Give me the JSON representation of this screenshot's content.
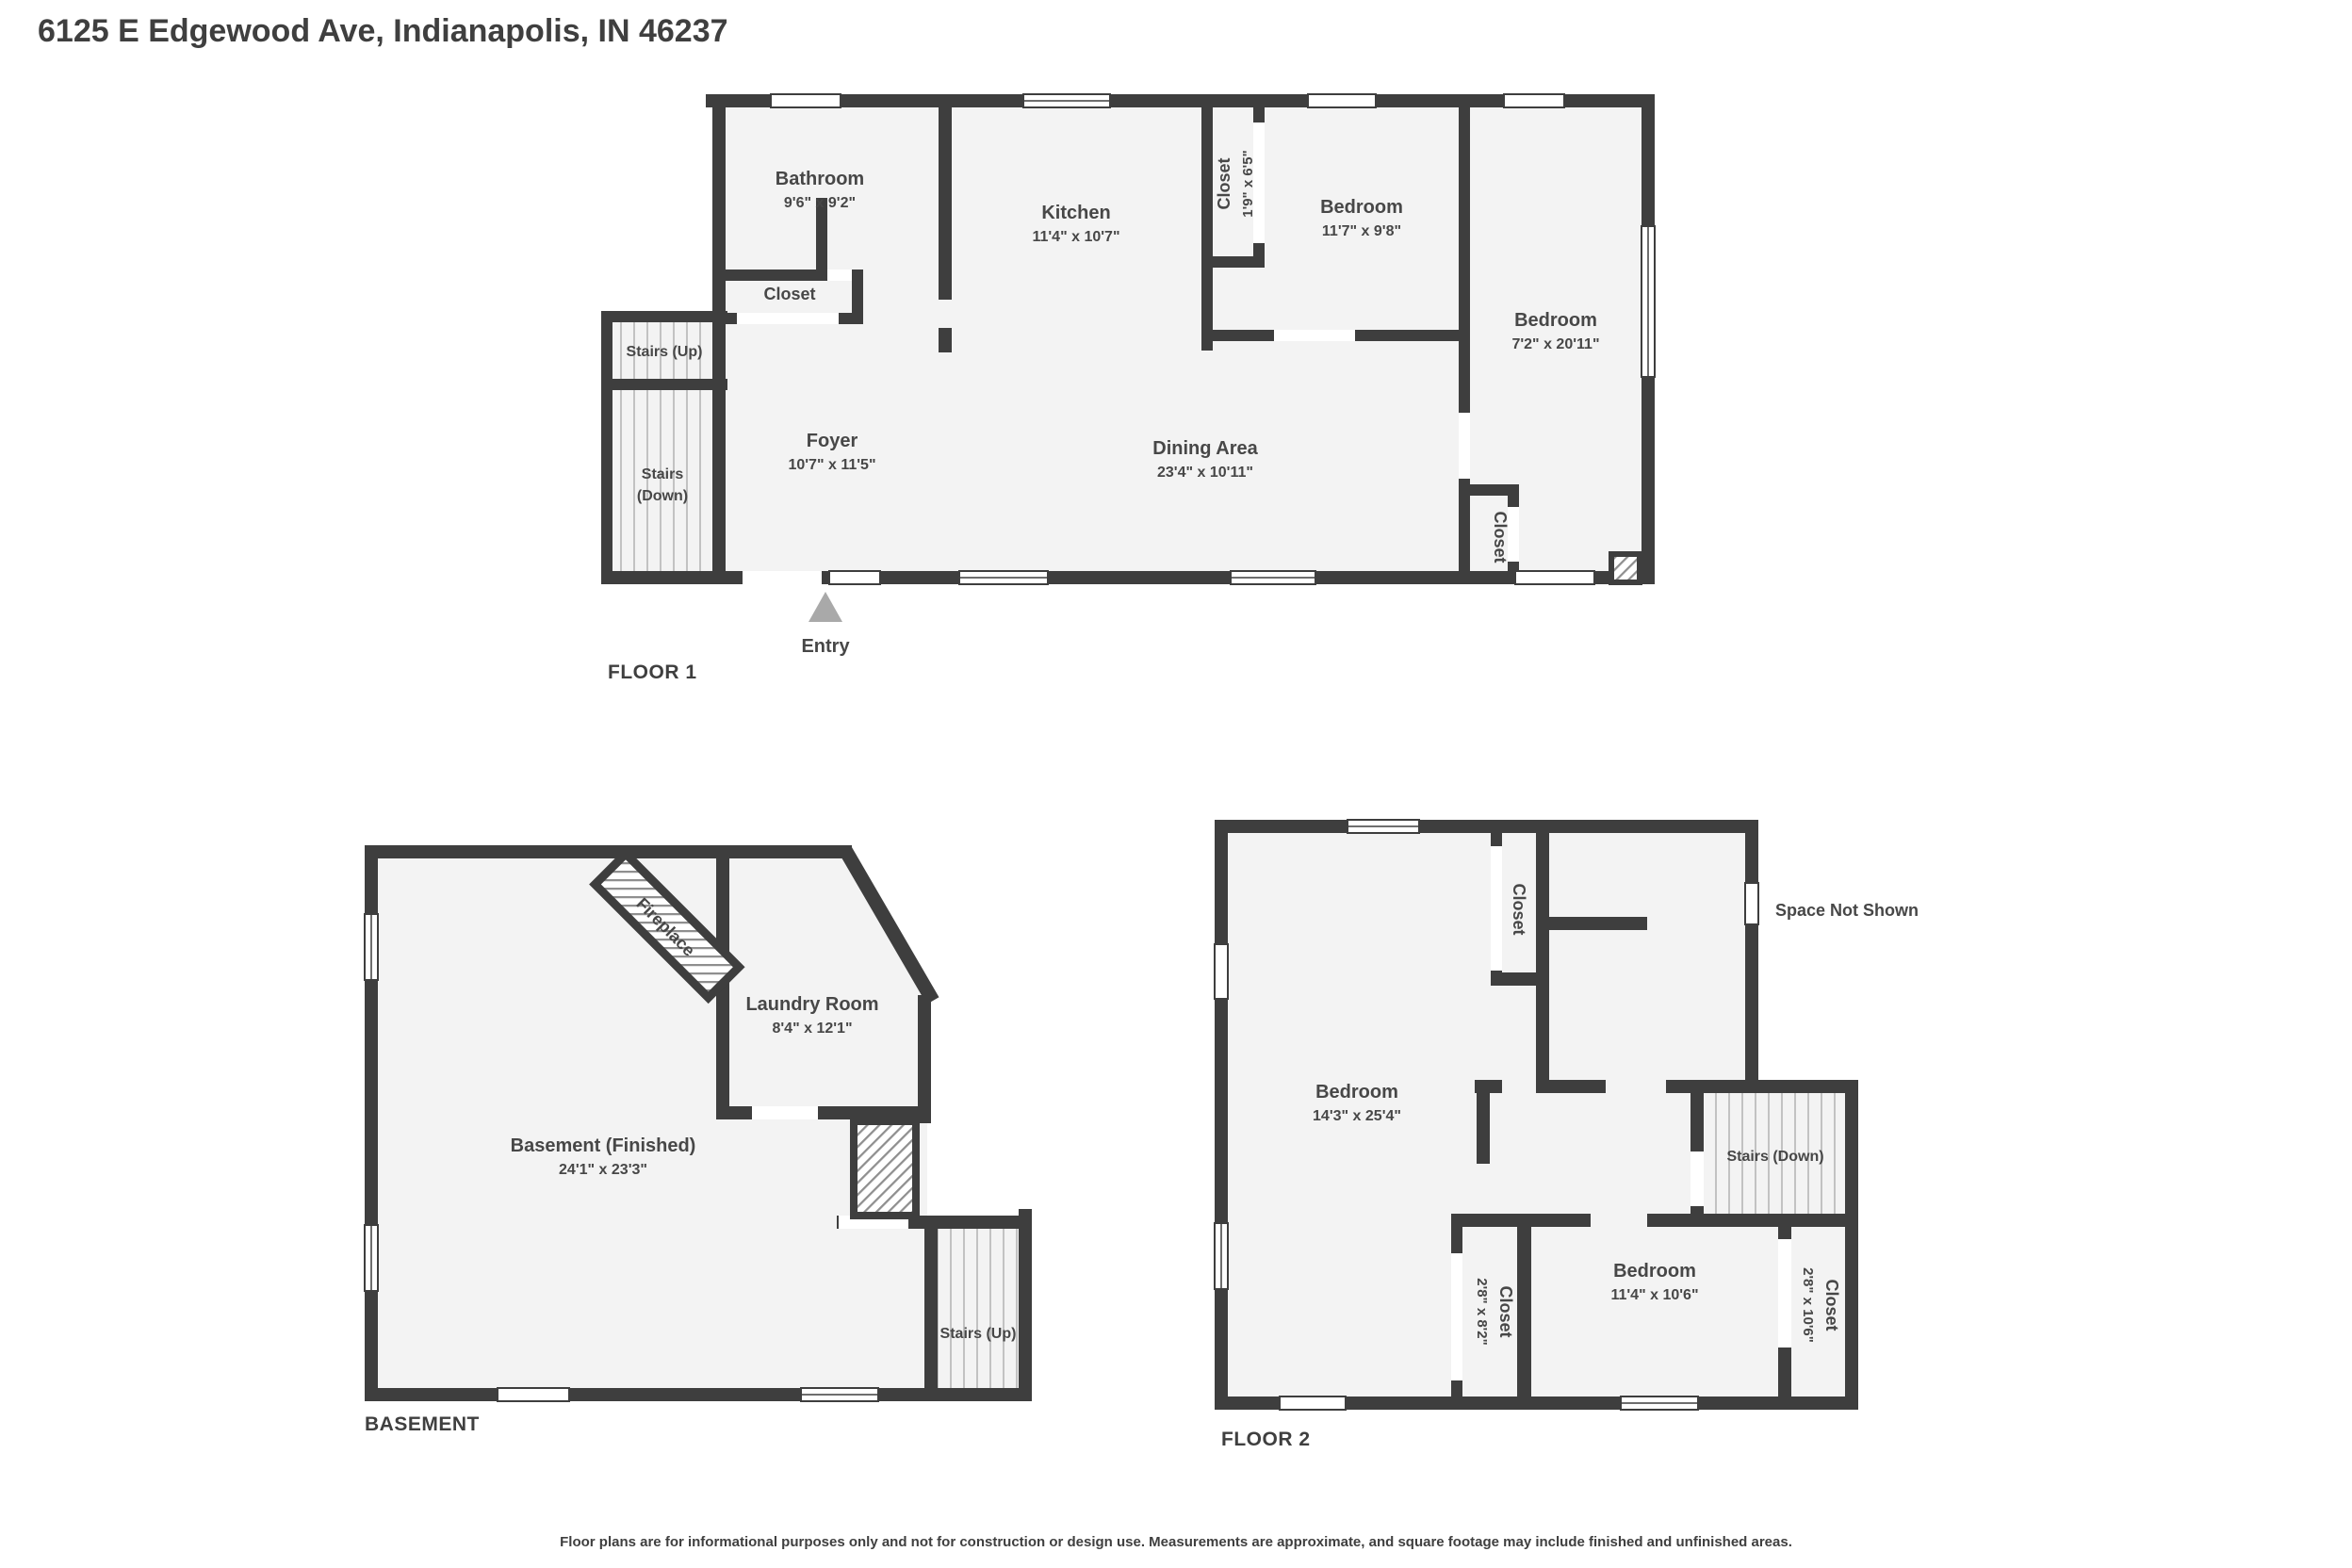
{
  "title": "6125 E Edgewood Ave, Indianapolis, IN 46237",
  "disclaimer": "Floor plans are for informational purposes only and not for construction or design use. Measurements are approximate, and square footage may include finished and unfinished areas.",
  "colors": {
    "wall": "#3e3e3e",
    "room_fill": "#f3f3f3",
    "text": "#474747",
    "entry_marker": "#a9a9a9",
    "tread_line": "#c2c2c2"
  },
  "floor1": {
    "label": "FLOOR 1",
    "bathroom": {
      "name": "Bathroom",
      "dims": "9'6\" x 9'2\""
    },
    "kitchen": {
      "name": "Kitchen",
      "dims": "11'4\" x 10'7\""
    },
    "closet_hall": {
      "name": "Closet"
    },
    "closet_kitchen": {
      "name": "Closet",
      "dims": "1'9\" x 6'5\""
    },
    "bedroom1": {
      "name": "Bedroom",
      "dims": "11'7\" x 9'8\""
    },
    "bedroom2": {
      "name": "Bedroom",
      "dims": "7'2\" x 20'11\""
    },
    "foyer": {
      "name": "Foyer",
      "dims": "10'7\" x 11'5\""
    },
    "dining": {
      "name": "Dining Area",
      "dims": "23'4\" x 10'11\""
    },
    "closet_dining": {
      "name": "Closet"
    },
    "stairs_up": "Stairs (Up)",
    "stairs_down_line1": "Stairs",
    "stairs_down_line2": "(Down)",
    "entry": "Entry"
  },
  "basement": {
    "label": "BASEMENT",
    "main": {
      "name": "Basement (Finished)",
      "dims": "24'1\" x 23'3\""
    },
    "laundry": {
      "name": "Laundry Room",
      "dims": "8'4\" x 12'1\""
    },
    "fireplace": "Fireplace",
    "stairs_up": "Stairs (Up)"
  },
  "floor2": {
    "label": "FLOOR 2",
    "bedroom1": {
      "name": "Bedroom",
      "dims": "14'3\" x 25'4\""
    },
    "bedroom2": {
      "name": "Bedroom",
      "dims": "11'4\" x 10'6\""
    },
    "closet_top": {
      "name": "Closet"
    },
    "closet_left": {
      "name": "Closet",
      "dims": "2'8\" x 8'2\""
    },
    "closet_right": {
      "name": "Closet",
      "dims": "2'8\" x 10'6\""
    },
    "stairs_down": "Stairs (Down)",
    "space_not_shown": "Space Not Shown"
  }
}
